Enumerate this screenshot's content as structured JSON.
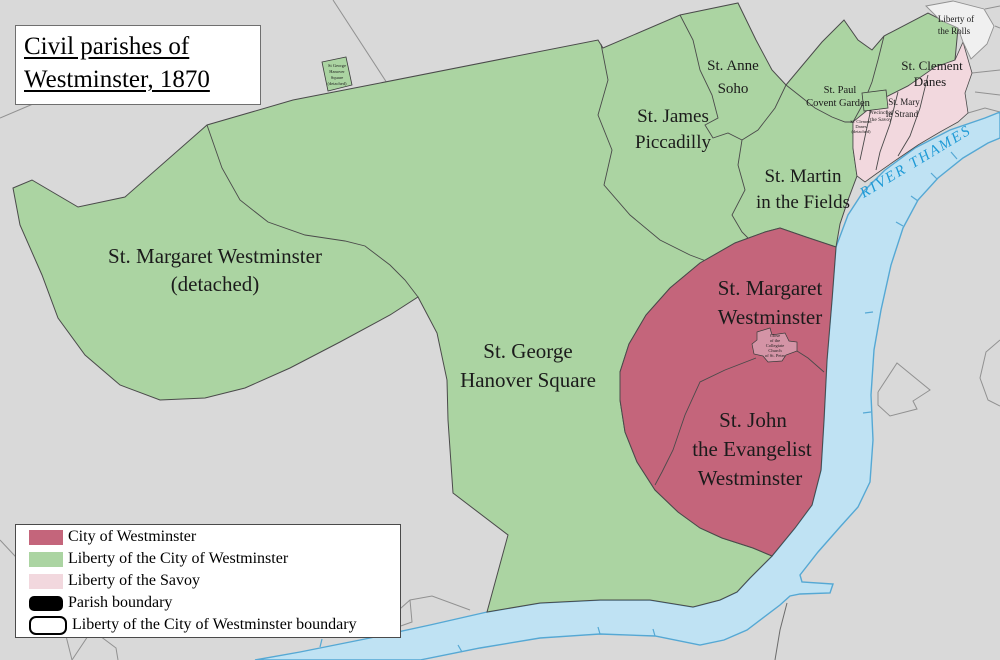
{
  "title": {
    "lines": [
      "Civil parishes of",
      "Westminster, 1870"
    ]
  },
  "colors": {
    "background": "#d9d9d9",
    "liberty_green": "#abd4a2",
    "city_red": "#c4657b",
    "savoy_pink": "#f2d8de",
    "abbey_close": "#d494a6",
    "rolls_fill": "#f0f0f0",
    "river_fill": "#bfe2f3",
    "river_stroke": "#55a8d4",
    "river_text": "#1e9ad6",
    "boundary": "#4a4a4a",
    "bg_line": "#919191"
  },
  "map": {
    "labels": {
      "st_margaret_detached": {
        "lines": [
          "St. Margaret Westminster",
          "(detached)"
        ]
      },
      "st_george": {
        "lines": [
          "St. George",
          "Hanover Square"
        ]
      },
      "st_james": {
        "lines": [
          "St. James",
          "Piccadilly"
        ]
      },
      "st_anne": {
        "lines": [
          "St. Anne",
          "Soho"
        ]
      },
      "st_martin": {
        "lines": [
          "St. Martin",
          "in the Fields"
        ]
      },
      "st_paul": {
        "lines": [
          "St. Paul",
          "Covent Garden"
        ]
      },
      "st_clement": {
        "lines": [
          "St. Clement",
          "Danes"
        ]
      },
      "st_mary": {
        "lines": [
          "St. Mary",
          "le Strand"
        ]
      },
      "liberty_rolls": {
        "lines": [
          "Liberty of",
          "the Rolls"
        ]
      },
      "st_margaret": {
        "lines": [
          "St. Margaret",
          "Westminster"
        ]
      },
      "st_john": {
        "lines": [
          "St. John",
          "the Evangelist",
          "Westminster"
        ]
      },
      "river": "RIVER THAMES",
      "precinct_savoy": {
        "lines": [
          "Precinct of",
          "the Savoy"
        ]
      },
      "clement_detached": {
        "lines": [
          "St. Clement",
          "Danes",
          "(detached)"
        ]
      },
      "george_detached": {
        "lines": [
          "St George",
          "Hanover",
          "Square",
          "(detached)"
        ]
      },
      "abbey_close": {
        "lines": [
          "Close",
          "of the",
          "Collegiate",
          "Church",
          "of St. Peter"
        ]
      }
    }
  },
  "legend": {
    "items": [
      {
        "label": "City of Westminster",
        "swatch": "city-red"
      },
      {
        "label": "Liberty of the City of Westminster",
        "swatch": "liberty-green"
      },
      {
        "label": "Liberty of the Savoy",
        "swatch": "savoy-pink"
      },
      {
        "label": "Parish boundary",
        "swatch": "parish-boundary-line"
      },
      {
        "label": "Liberty of the City of Westminster boundary",
        "swatch": "liberty-boundary-outline"
      }
    ]
  }
}
